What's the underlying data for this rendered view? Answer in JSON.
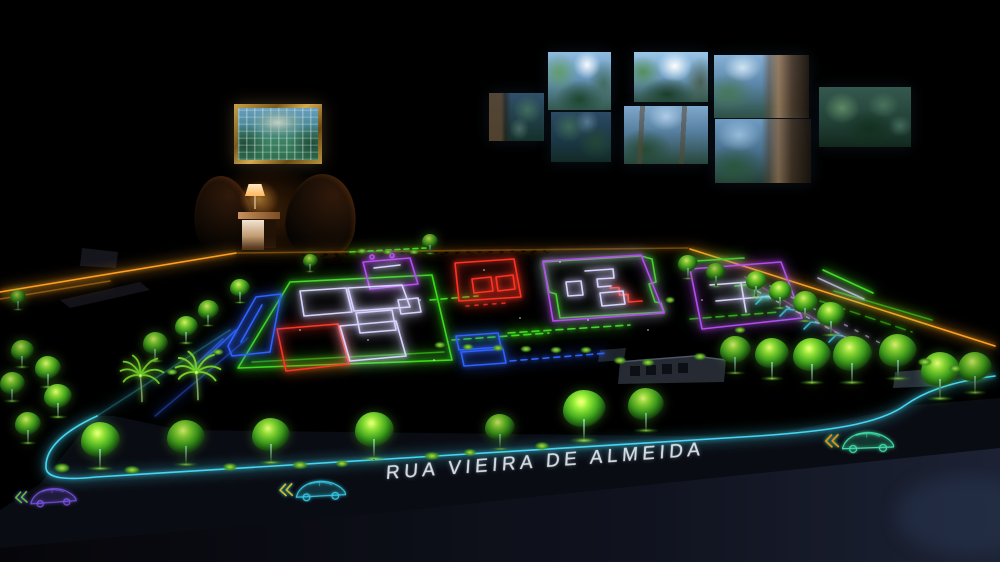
{
  "scene": {
    "title": "illuminated-masterplan-model-room",
    "street_label": "RUA VIEIRA DE ALMEIDA",
    "artwork": "garden-aerial-painting",
    "colors": {
      "amber": "#ffa020",
      "cyan": "#45d6f2",
      "green": "#3ddc1e",
      "red": "#ff3322",
      "blue": "#2e62ff",
      "purple": "#b44dee",
      "lavender": "#d8d4ff",
      "pink": "#c857b8",
      "carPurple": "#7a55e8",
      "carCyan": "#35cde8",
      "carTeal": "#3fe0a8",
      "chevGreen": "#55c832",
      "chevYellow": "#d8c020",
      "chevAmber": "#e88f1a",
      "lampWarm": "#ffae45",
      "textWhite": "#e4ecf0"
    },
    "screens": [
      {
        "x": 489,
        "y": 93,
        "w": 55,
        "h": 48,
        "v": "v-darktrunk"
      },
      {
        "x": 548,
        "y": 52,
        "w": 63,
        "h": 58,
        "v": "v-bright"
      },
      {
        "x": 634,
        "y": 52,
        "w": 74,
        "h": 50,
        "v": "v-sun"
      },
      {
        "x": 714,
        "y": 55,
        "w": 95,
        "h": 63,
        "v": "v-trunkr"
      },
      {
        "x": 551,
        "y": 112,
        "w": 60,
        "h": 50,
        "v": "v-dark"
      },
      {
        "x": 624,
        "y": 106,
        "w": 84,
        "h": 58,
        "v": "v-mid"
      },
      {
        "x": 715,
        "y": 119,
        "w": 96,
        "h": 64,
        "v": "v-trunkr2"
      },
      {
        "x": 819,
        "y": 87,
        "w": 92,
        "h": 60,
        "v": "v-darkleaf"
      }
    ],
    "trees": [
      {
        "x": 100,
        "y": 470,
        "h": 48,
        "b": 1.05
      },
      {
        "x": 186,
        "y": 466,
        "h": 46,
        "b": 0.9
      },
      {
        "x": 271,
        "y": 464,
        "h": 46,
        "b": 1.0
      },
      {
        "x": 374,
        "y": 460,
        "h": 48,
        "b": 1.05
      },
      {
        "x": 500,
        "y": 450,
        "h": 36,
        "b": 0.85
      },
      {
        "x": 584,
        "y": 442,
        "h": 52,
        "b": 1.1
      },
      {
        "x": 646,
        "y": 432,
        "h": 44,
        "b": 0.95
      },
      {
        "x": 735,
        "y": 374,
        "h": 38,
        "b": 0.9
      },
      {
        "x": 772,
        "y": 380,
        "h": 42,
        "b": 1.0
      },
      {
        "x": 812,
        "y": 384,
        "h": 46,
        "b": 1.05
      },
      {
        "x": 852,
        "y": 384,
        "h": 48,
        "b": 1.0
      },
      {
        "x": 898,
        "y": 380,
        "h": 46,
        "b": 0.95
      },
      {
        "x": 940,
        "y": 400,
        "h": 48,
        "b": 1.0
      },
      {
        "x": 975,
        "y": 394,
        "h": 42,
        "b": 0.85
      },
      {
        "x": 756,
        "y": 297,
        "h": 26,
        "b": 0.95
      },
      {
        "x": 780,
        "y": 309,
        "h": 28,
        "b": 1.0
      },
      {
        "x": 805,
        "y": 322,
        "h": 31,
        "b": 0.95
      },
      {
        "x": 831,
        "y": 336,
        "h": 34,
        "b": 1.0
      },
      {
        "x": 688,
        "y": 279,
        "h": 24,
        "b": 0.9
      },
      {
        "x": 716,
        "y": 287,
        "h": 24,
        "b": 0.8
      },
      {
        "x": 240,
        "y": 303,
        "h": 24,
        "b": 0.95
      },
      {
        "x": 208,
        "y": 326,
        "h": 26,
        "b": 0.9
      },
      {
        "x": 186,
        "y": 344,
        "h": 28,
        "b": 0.95
      },
      {
        "x": 155,
        "y": 362,
        "h": 30,
        "b": 0.85
      },
      {
        "x": 22,
        "y": 368,
        "h": 28,
        "b": 0.8
      },
      {
        "x": 48,
        "y": 388,
        "h": 32,
        "b": 0.95
      },
      {
        "x": 12,
        "y": 402,
        "h": 30,
        "b": 0.85
      },
      {
        "x": 58,
        "y": 418,
        "h": 34,
        "b": 1.0
      },
      {
        "x": 28,
        "y": 444,
        "h": 32,
        "b": 0.9
      },
      {
        "x": 18,
        "y": 310,
        "h": 20,
        "b": 0.7
      },
      {
        "x": 310,
        "y": 272,
        "h": 18,
        "b": 0.8
      },
      {
        "x": 430,
        "y": 254,
        "h": 20,
        "b": 0.8
      },
      {
        "x": 142,
        "y": 410,
        "h": 56,
        "t": "palm",
        "b": 1.0
      },
      {
        "x": 198,
        "y": 408,
        "h": 58,
        "t": "palm",
        "b": 1.05
      }
    ],
    "bushes": [
      {
        "x": 62,
        "y": 468,
        "s": 1.3
      },
      {
        "x": 132,
        "y": 470,
        "s": 1.2
      },
      {
        "x": 230,
        "y": 467,
        "s": 1.1
      },
      {
        "x": 300,
        "y": 465,
        "s": 1.2
      },
      {
        "x": 342,
        "y": 463,
        "s": 1.0
      },
      {
        "x": 432,
        "y": 456,
        "s": 1.2
      },
      {
        "x": 470,
        "y": 452,
        "s": 1.0
      },
      {
        "x": 542,
        "y": 446,
        "s": 1.1
      },
      {
        "x": 440,
        "y": 345,
        "s": 0.9
      },
      {
        "x": 468,
        "y": 347,
        "s": 0.9
      },
      {
        "x": 498,
        "y": 348,
        "s": 0.9
      },
      {
        "x": 526,
        "y": 349,
        "s": 0.9
      },
      {
        "x": 556,
        "y": 350,
        "s": 0.9
      },
      {
        "x": 586,
        "y": 350,
        "s": 0.9
      },
      {
        "x": 362,
        "y": 251,
        "s": 0.7
      },
      {
        "x": 388,
        "y": 252,
        "s": 0.7
      },
      {
        "x": 414,
        "y": 252,
        "s": 0.7
      },
      {
        "x": 620,
        "y": 360,
        "s": 1.0
      },
      {
        "x": 648,
        "y": 362,
        "s": 1.0
      },
      {
        "x": 925,
        "y": 362,
        "s": 1.1
      },
      {
        "x": 955,
        "y": 368,
        "s": 1.0
      },
      {
        "x": 218,
        "y": 352,
        "s": 0.9
      },
      {
        "x": 172,
        "y": 372,
        "s": 0.9
      },
      {
        "x": 700,
        "y": 356,
        "s": 1.0
      },
      {
        "x": 670,
        "y": 300,
        "s": 0.8
      },
      {
        "x": 740,
        "y": 330,
        "s": 0.9
      }
    ],
    "cars": [
      {
        "x": 12,
        "y": 484,
        "w": 70,
        "rot": -4,
        "body": "carPurple",
        "chev": "chevGreen"
      },
      {
        "x": 276,
        "y": 476,
        "w": 76,
        "rot": -3,
        "body": "carCyan",
        "chev": "chevYellow"
      },
      {
        "x": 822,
        "y": 427,
        "w": 78,
        "rot": -2,
        "body": "carTeal",
        "chev": "chevAmber"
      }
    ]
  }
}
